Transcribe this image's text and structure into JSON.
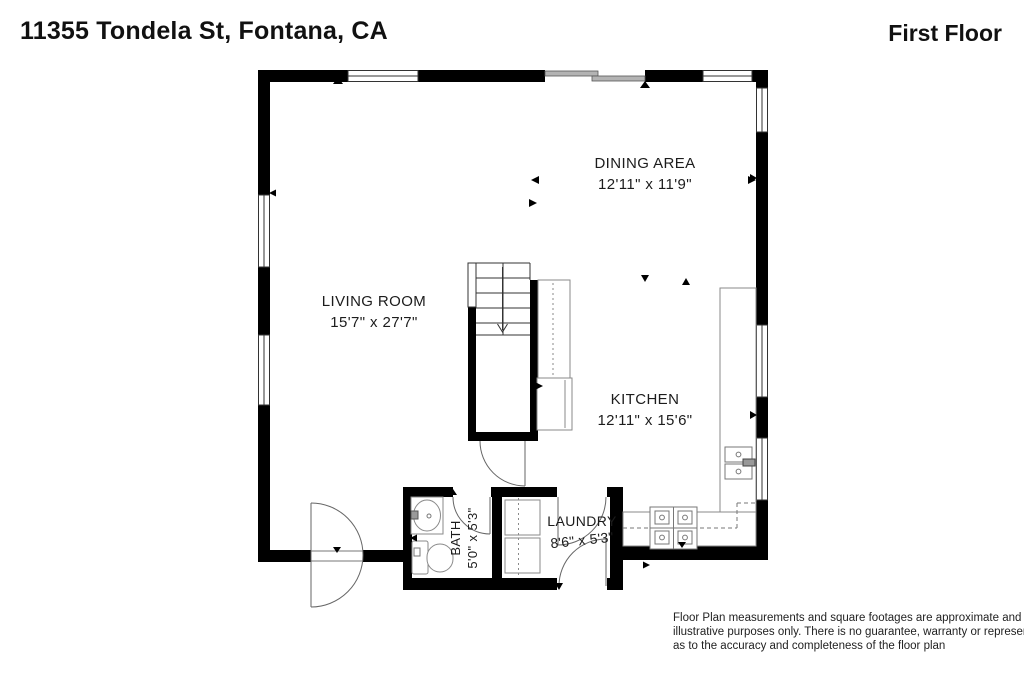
{
  "header": {
    "address": "11355 Tondela St, Fontana, CA",
    "floor_label": "First Floor"
  },
  "rooms": {
    "dining": {
      "name": "DINING AREA",
      "dimensions": "12'11\" x 11'9\""
    },
    "living": {
      "name": "LIVING ROOM",
      "dimensions": "15'7\" x 27'7\""
    },
    "kitchen": {
      "name": "KITCHEN",
      "dimensions": "12'11\" x 15'6\""
    },
    "bath": {
      "name": "BATH",
      "dimensions": "5'0\" x 5'3\""
    },
    "laundry": {
      "name": "LAUNDRY",
      "dimensions": "8'6\" x 5'3\""
    }
  },
  "fixtures": [
    "staircase-down-arrow",
    "refrigerator",
    "pantry-cabinet",
    "kitchen-counter",
    "kitchen-sink",
    "stove-cooktop",
    "washer",
    "dryer",
    "bathroom-sink-vanity",
    "toilet",
    "entry-door",
    "sliding-glass-door",
    "windows"
  ],
  "disclaimer": {
    "line1": "Floor Plan measurements and square footages are approximate and are for",
    "line2": "illustrative purposes only. There is no guarantee, warranty or representation",
    "line3": "as to the accuracy and completeness of the floor plan"
  },
  "colors": {
    "wall": "#000000",
    "fixture_line": "#8a8a8a",
    "door_line": "#666666",
    "slider_fill": "#b3b3b3",
    "text": "#1c1c1c"
  }
}
